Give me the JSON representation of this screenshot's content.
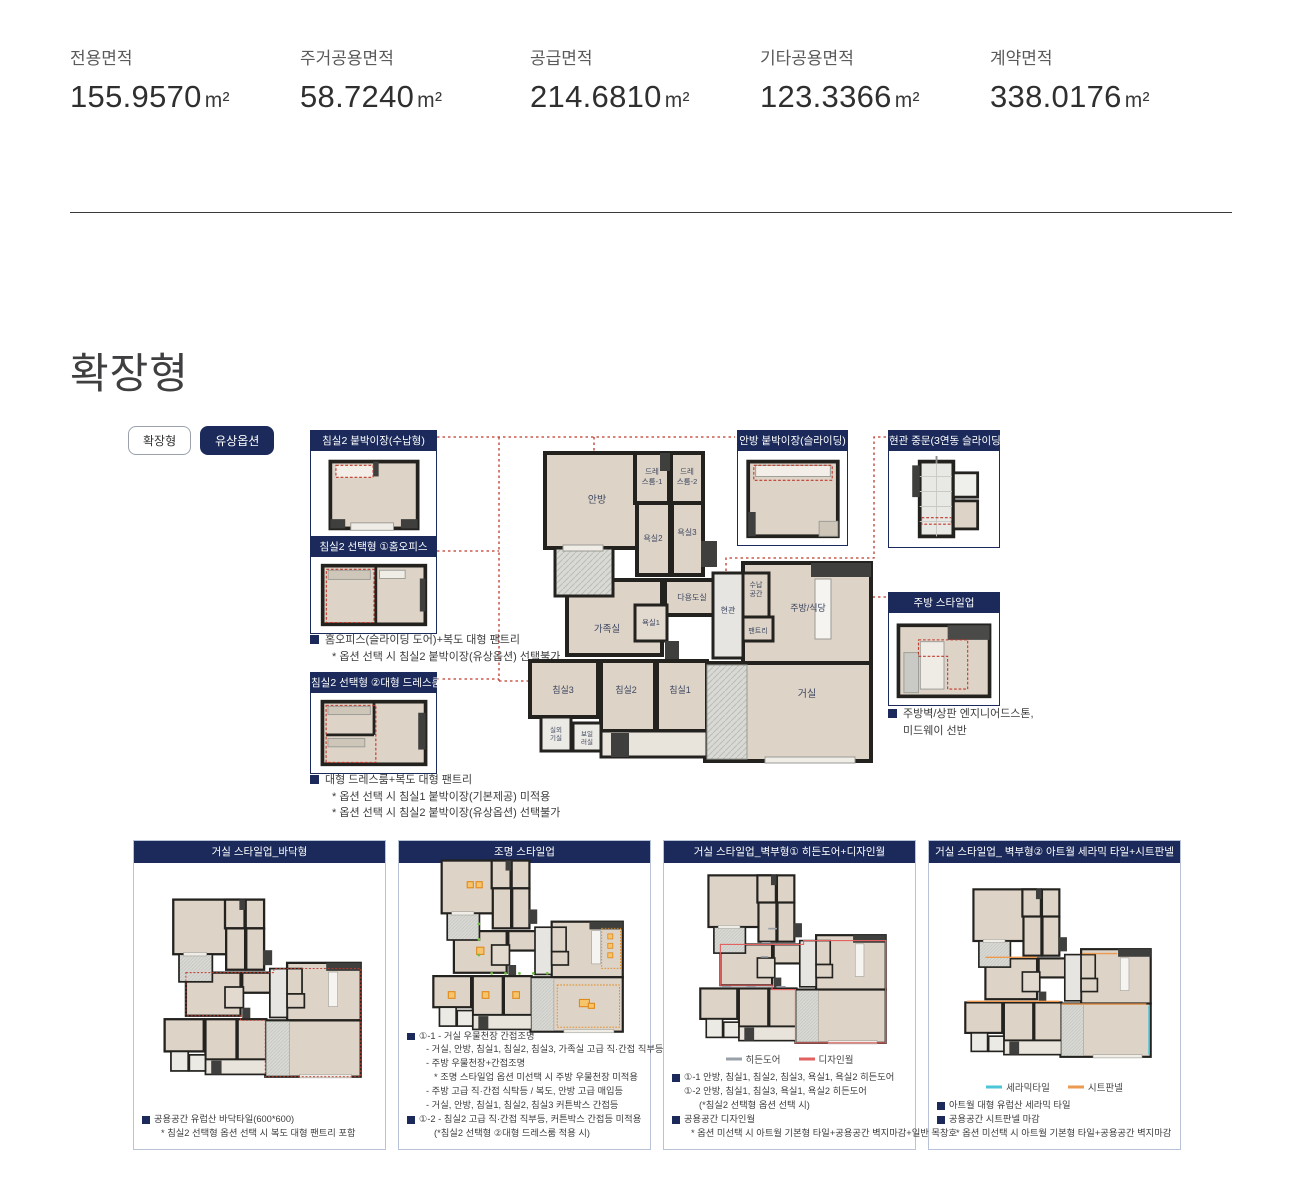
{
  "stats": [
    {
      "label": "전용면적",
      "value": "155.9570",
      "unit": "m²"
    },
    {
      "label": "주거공용면적",
      "value": "58.7240",
      "unit": "m²"
    },
    {
      "label": "공급면적",
      "value": "214.6810",
      "unit": "m²"
    },
    {
      "label": "기타공용면적",
      "value": "123.3366",
      "unit": "m²"
    },
    {
      "label": "계약면적",
      "value": "338.0176",
      "unit": "m²"
    }
  ],
  "section": {
    "title": "확장형"
  },
  "toggles": {
    "expand": "확장형",
    "paid_option": "유상옵션"
  },
  "callouts": {
    "bedroom2_wardrobe": {
      "title": "침실2 붙박이장(수납형)"
    },
    "bedroom2_office": {
      "title": "침실2 선택형 ①홈오피스",
      "notes": [
        "홈오피스(슬라이딩 도어)+복도 대형 팬트리",
        "* 옵션 선택 시 침실2 붙박이장(유상옵션) 선택불가"
      ]
    },
    "bedroom2_dressroom": {
      "title": "침실2 선택형 ②대형 드레스룸",
      "notes": [
        "대형 드레스룸+복도 대형 팬트리",
        "* 옵션 선택 시 침실1 붙박이장(기본제공) 미적용",
        "* 옵션 선택 시 침실2 붙박이장(유상옵션) 선택불가"
      ]
    },
    "master_wardrobe": {
      "title": "안방 붙박이장(슬라이딩)"
    },
    "entrance_door": {
      "title": "현관 중문(3연동 슬라이딩)"
    },
    "kitchen_styleup": {
      "title": "주방 스타일업",
      "notes": [
        "주방벽/상판 엔지니어드스톤,",
        "미드웨이 선반"
      ]
    }
  },
  "plan": {
    "rooms": {
      "master": "안방",
      "dress1_l1": "드레",
      "dress1_l2": "스룸-1",
      "dress2_l1": "드레",
      "dress2_l2": "스룸-2",
      "bath2": "욕실2",
      "bath3": "욕실3",
      "utility": "다용도실",
      "family": "가족실",
      "bath1": "욕실1",
      "entrance": "현관",
      "storage_l1": "수납",
      "storage_l2": "공간",
      "pantry": "팬트리",
      "kitchen": "주방/식당",
      "bed3": "침실3",
      "bed2": "침실2",
      "bed1": "침실1",
      "living": "거실",
      "outdoor_l1": "실외",
      "outdoor_l2": "기실",
      "boiler_l1": "보일",
      "boiler_l2": "러실"
    }
  },
  "cards": [
    {
      "title": "거실 스타일업_바닥형",
      "lines": [
        {
          "text": "공용공간 유럽산 바닥타일(600*600)"
        },
        {
          "text": "* 침실2 선택형 옵션 선택 시 복도 대형 팬트리 포함"
        }
      ]
    },
    {
      "title": "조명 스타일업",
      "lines": [
        {
          "text": "①-1 - 거실 우물천장 간접조명"
        },
        {
          "text": "- 거실, 안방, 침실1, 침실2, 침실3, 가족실 고급 직·간접 직부등"
        },
        {
          "text": "- 주방 우물천장+간접조명"
        },
        {
          "text": "* 조명 스타일업 옵션 미선택 시 주방 우물천장 미적용"
        },
        {
          "text": "- 주방 고급 직·간접 식탁등 / 복도, 안방 고급 매입등"
        },
        {
          "text": "- 거실, 안방, 침실1, 침실2, 침실3 커튼박스 간접등"
        },
        {
          "text": "①-2 - 침실2 고급 직·간접 직부등, 커튼박스 간접등 미적용"
        },
        {
          "text": "(*침실2 선택형 ②대형 드레스룸 적용 시)"
        }
      ]
    },
    {
      "title": "거실 스타일업_벽부형① 히든도어+디자인월",
      "legend": [
        {
          "label": "히든도어",
          "color": "#9aa0a8"
        },
        {
          "label": "디자인월",
          "color": "#e26161"
        }
      ],
      "lines": [
        {
          "text": "①-1 안방, 침실1, 침실2, 침실3, 욕실1, 욕실2 히든도어"
        },
        {
          "text": "①-2 안방, 침실1, 침실3, 욕실1, 욕실2 히든도어"
        },
        {
          "text": "(*침실2 선택형 옵션 선택 시)"
        },
        {
          "text": "공용공간 디자인월"
        },
        {
          "text": "* 옵션 미선택 시 아트월 기본형 타일+공용공간 벽지마감+일반 목창호"
        }
      ]
    },
    {
      "title": "거실 스타일업_ 벽부형② 아트월 세라믹 타일+시트판넬",
      "legend": [
        {
          "label": "세라믹타일",
          "color": "#4cc5d9"
        },
        {
          "label": "시트판넬",
          "color": "#ec9a50"
        }
      ],
      "lines": [
        {
          "text": "아트월 대형 유럽산 세라믹 타일"
        },
        {
          "text": "공용공간 시트판넬 마감"
        },
        {
          "text": "* 옵션 미선택 시 아트월 기본형 타일+공용공간 벽지마감"
        }
      ]
    }
  ],
  "colors": {
    "navy": "#1b2a5a",
    "red_leader": "#c0392b",
    "floor": "#ddd3c7",
    "hidden_door": "#9aa0a8",
    "design_wall": "#e26161",
    "ceramic_tile": "#4cc5d9",
    "sheet_panel": "#ec9a50"
  }
}
